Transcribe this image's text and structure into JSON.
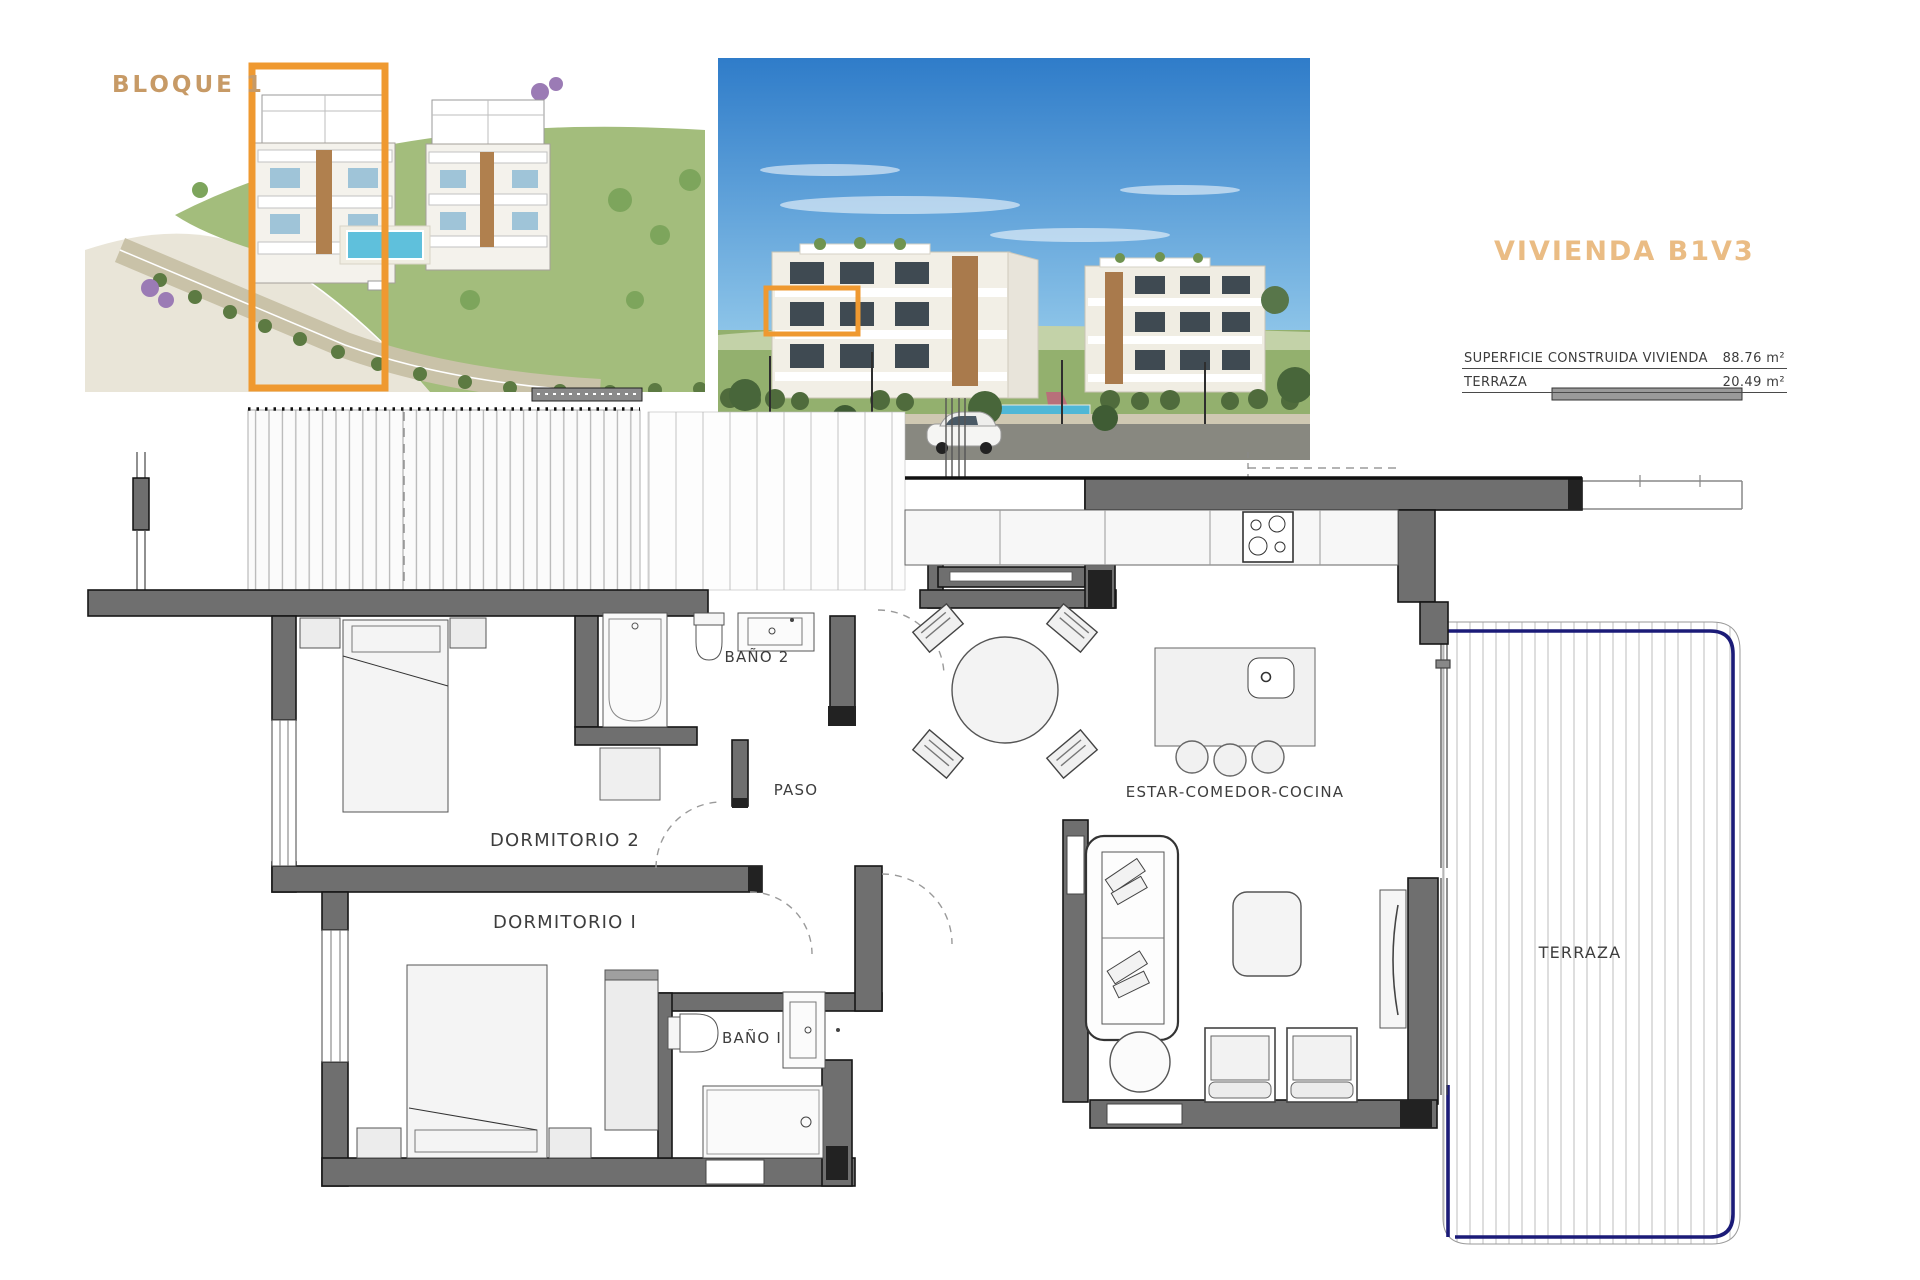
{
  "colors": {
    "accent_orange": "#ef9930",
    "block_label_tan": "#c79a66",
    "title_tan": "#eabc84",
    "wall_gray": "#6f6f6f",
    "terrace_edge_navy": "#1b1b78",
    "pool_blue": "#5fc0dc"
  },
  "overview": {
    "block_label": "BLOQUE 1"
  },
  "title_block": {
    "title": "VIVIENDA B1V3",
    "rows": [
      {
        "label": "SUPERFICIE CONSTRUIDA VIVIENDA",
        "value": "88.76 m²"
      },
      {
        "label": "TERRAZA",
        "value": "20.49 m²"
      }
    ]
  },
  "floor_plan": {
    "labels": {
      "dormitorio2": "DORMITORIO 2",
      "dormitorio1": "DORMITORIO I",
      "bano2": "BAÑO 2",
      "bano1": "BAÑO I",
      "paso": "PASO",
      "estar": "ESTAR-COMEDOR-COCINA",
      "terraza": "TERRAZA"
    }
  }
}
